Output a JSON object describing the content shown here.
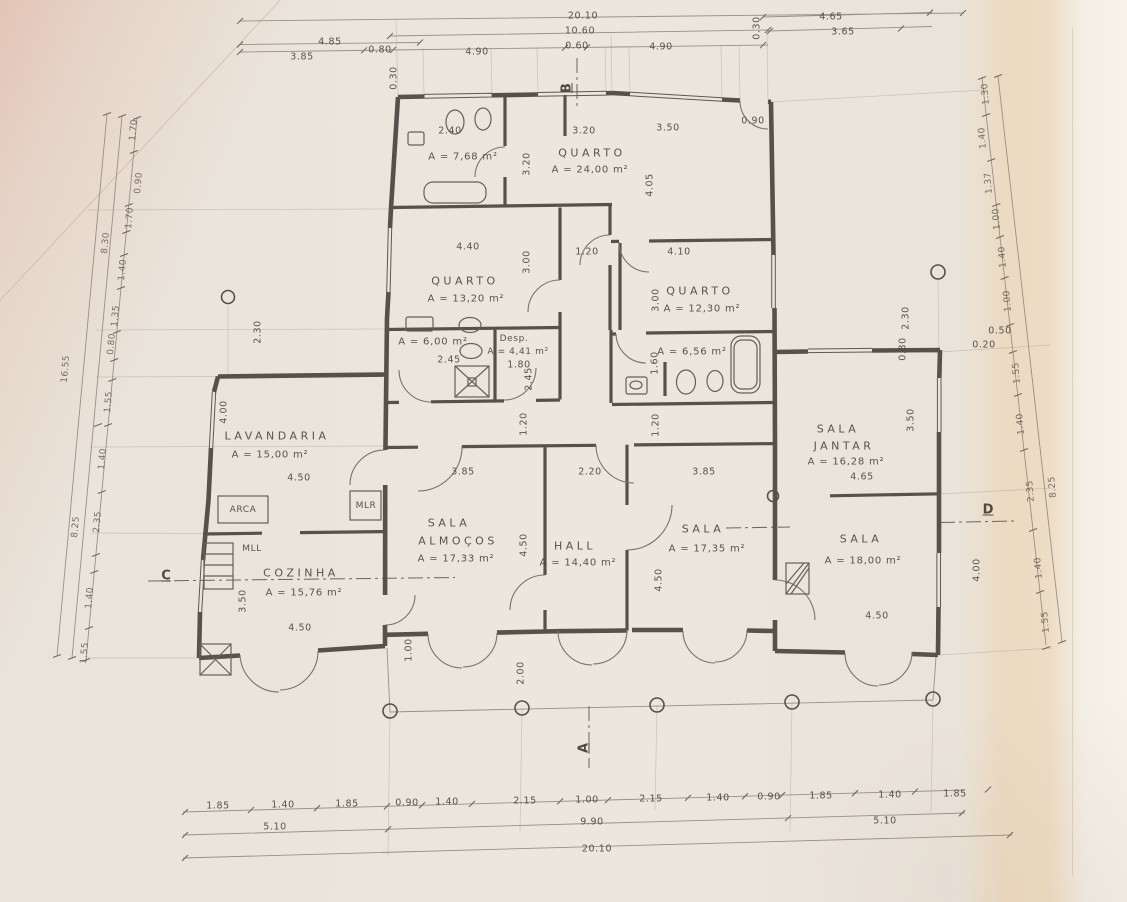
{
  "palette": {
    "paper": "#ebe5dc",
    "ink": "#56514b",
    "dim_line": "#9a9187",
    "text": "#49423a",
    "pink_fold": "#ddA694",
    "orange_band": "#e7b26e"
  },
  "drawing": {
    "type": "scanned architectural floor plan",
    "section_markers": [
      "A",
      "B",
      "C",
      "D"
    ]
  },
  "rooms": [
    {
      "name": "QUARTO",
      "area": "A = 24,00 m²"
    },
    {
      "name": "QUARTO",
      "area": "A = 13,20 m²"
    },
    {
      "name": "QUARTO",
      "area": "A = 12,30 m²"
    },
    {
      "name": "",
      "area": "A = 7,68 m²"
    },
    {
      "name": "",
      "area": "A = 6,00 m²"
    },
    {
      "name": "Desp.",
      "area": "A = 4,41 m²"
    },
    {
      "name": "",
      "area": "A = 6,56 m²"
    },
    {
      "name": "LAVANDARIA",
      "area": "A = 15,00 m²"
    },
    {
      "name": "COZINHA",
      "area": "A = 15,76 m²"
    },
    {
      "name": "SALA ALMOÇOS",
      "area": "A = 17,33 m²"
    },
    {
      "name": "HALL",
      "area": "A = 14,40 m²"
    },
    {
      "name": "SALA",
      "area": "A = 17,35 m²"
    },
    {
      "name": "SALA JANTAR",
      "area": "A = 16,28 m²"
    },
    {
      "name": "SALA",
      "area": "A = 18,00 m²"
    }
  ],
  "labels": [
    {
      "t": "QUARTO",
      "x": 592,
      "y": 153,
      "c": "room",
      "n": "room-label-quarto-24"
    },
    {
      "t": "A = 24,00 m²",
      "x": 590,
      "y": 170,
      "c": "area"
    },
    {
      "t": "A = 7,68 m²",
      "x": 463,
      "y": 157,
      "c": "area"
    },
    {
      "t": "QUARTO",
      "x": 465,
      "y": 281,
      "c": "room",
      "n": "room-label-quarto-13"
    },
    {
      "t": "A = 13,20 m²",
      "x": 466,
      "y": 299,
      "c": "area"
    },
    {
      "t": "QUARTO",
      "x": 700,
      "y": 291,
      "c": "room",
      "n": "room-label-quarto-12"
    },
    {
      "t": "A = 12,30 m²",
      "x": 702,
      "y": 309,
      "c": "area"
    },
    {
      "t": "A = 6,00 m²",
      "x": 433,
      "y": 342,
      "c": "area"
    },
    {
      "t": "Desp.",
      "x": 514,
      "y": 339,
      "c": "sm",
      "n": "room-label-despensa"
    },
    {
      "t": "A = 4,41 m²",
      "x": 518,
      "y": 352,
      "c": "sm"
    },
    {
      "t": "1.80",
      "x": 519,
      "y": 365,
      "c": "dim"
    },
    {
      "t": "A = 6,56 m²",
      "x": 692,
      "y": 352,
      "c": "area"
    },
    {
      "t": "LAVANDARIA",
      "x": 277,
      "y": 436,
      "c": "room",
      "n": "room-label-lavandaria"
    },
    {
      "t": "A = 15,00 m²",
      "x": 270,
      "y": 455,
      "c": "area"
    },
    {
      "t": "ARCA",
      "x": 243,
      "y": 510,
      "c": "sm",
      "n": "fixture-label-arca"
    },
    {
      "t": "MLR",
      "x": 366,
      "y": 506,
      "c": "sm",
      "n": "fixture-label-mlr"
    },
    {
      "t": "MLL",
      "x": 252,
      "y": 549,
      "c": "sm",
      "n": "fixture-label-mll"
    },
    {
      "t": "COZINHA",
      "x": 301,
      "y": 573,
      "c": "room",
      "n": "room-label-cozinha"
    },
    {
      "t": "A = 15,76 m²",
      "x": 304,
      "y": 593,
      "c": "area"
    },
    {
      "t": "SALA",
      "x": 449,
      "y": 523,
      "c": "room",
      "n": "room-label-sala-almocos"
    },
    {
      "t": "ALMOÇOS",
      "x": 458,
      "y": 541,
      "c": "room"
    },
    {
      "t": "A = 17,33 m²",
      "x": 456,
      "y": 559,
      "c": "area"
    },
    {
      "t": "HALL",
      "x": 575,
      "y": 546,
      "c": "room",
      "n": "room-label-hall"
    },
    {
      "t": "A = 14,40 m²",
      "x": 578,
      "y": 563,
      "c": "area"
    },
    {
      "t": "SALA",
      "x": 703,
      "y": 529,
      "c": "room",
      "n": "room-label-sala-17"
    },
    {
      "t": "A = 17,35 m²",
      "x": 707,
      "y": 549,
      "c": "area"
    },
    {
      "t": "SALA",
      "x": 838,
      "y": 429,
      "c": "room",
      "n": "room-label-sala-jantar"
    },
    {
      "t": "JANTAR",
      "x": 844,
      "y": 446,
      "c": "room"
    },
    {
      "t": "A = 16,28 m²",
      "x": 846,
      "y": 462,
      "c": "area"
    },
    {
      "t": "4.65",
      "x": 862,
      "y": 477,
      "c": "dim"
    },
    {
      "t": "SALA",
      "x": 861,
      "y": 539,
      "c": "room",
      "n": "room-label-sala-18"
    },
    {
      "t": "A = 18,00 m²",
      "x": 863,
      "y": 561,
      "c": "area"
    },
    {
      "t": "2.40",
      "x": 450,
      "y": 131,
      "c": "dim"
    },
    {
      "t": "3.20",
      "x": 584,
      "y": 131,
      "c": "dim"
    },
    {
      "t": "3.50",
      "x": 668,
      "y": 128,
      "c": "dim"
    },
    {
      "t": "0.90",
      "x": 753,
      "y": 121,
      "c": "dim"
    },
    {
      "t": "4.40",
      "x": 468,
      "y": 247,
      "c": "dim"
    },
    {
      "t": "1.20",
      "x": 587,
      "y": 252,
      "c": "dim"
    },
    {
      "t": "4.10",
      "x": 679,
      "y": 252,
      "c": "dim"
    },
    {
      "t": "2.45",
      "x": 449,
      "y": 360,
      "c": "dim"
    },
    {
      "t": "3.85",
      "x": 463,
      "y": 472,
      "c": "dim"
    },
    {
      "t": "2.20",
      "x": 590,
      "y": 472,
      "c": "dim"
    },
    {
      "t": "3.85",
      "x": 704,
      "y": 472,
      "c": "dim"
    },
    {
      "t": "4.50",
      "x": 299,
      "y": 478,
      "c": "dim"
    },
    {
      "t": "4.50",
      "x": 300,
      "y": 628,
      "c": "dim"
    },
    {
      "t": "4.50",
      "x": 877,
      "y": 616,
      "c": "dim"
    },
    {
      "t": "0.50",
      "x": 1000,
      "y": 331,
      "c": "dim"
    },
    {
      "t": "0.20",
      "x": 984,
      "y": 345,
      "c": "dim"
    },
    {
      "t": "3.20",
      "x": 527,
      "y": 164,
      "r": -90,
      "c": "dim"
    },
    {
      "t": "4.05",
      "x": 650,
      "y": 185,
      "r": -90,
      "c": "dim"
    },
    {
      "t": "3.00",
      "x": 527,
      "y": 262,
      "r": -90,
      "c": "dim"
    },
    {
      "t": "3.00",
      "x": 656,
      "y": 300,
      "r": -90,
      "c": "dim"
    },
    {
      "t": "2.45",
      "x": 529,
      "y": 379,
      "r": -90,
      "c": "dim"
    },
    {
      "t": "1.60",
      "x": 655,
      "y": 363,
      "r": -90,
      "c": "dim"
    },
    {
      "t": "1.20",
      "x": 524,
      "y": 424,
      "r": -90,
      "c": "dim"
    },
    {
      "t": "1.20",
      "x": 656,
      "y": 425,
      "r": -90,
      "c": "dim"
    },
    {
      "t": "4.50",
      "x": 524,
      "y": 545,
      "r": -90,
      "c": "dim"
    },
    {
      "t": "4.50",
      "x": 659,
      "y": 580,
      "r": -90,
      "c": "dim"
    },
    {
      "t": "4.00",
      "x": 224,
      "y": 412,
      "r": -90,
      "c": "dim"
    },
    {
      "t": "2.30",
      "x": 258,
      "y": 332,
      "r": -90,
      "c": "dim"
    },
    {
      "t": "3.50",
      "x": 243,
      "y": 601,
      "r": -90,
      "c": "dim"
    },
    {
      "t": "1.00",
      "x": 409,
      "y": 650,
      "r": -90,
      "c": "dim"
    },
    {
      "t": "2.00",
      "x": 521,
      "y": 673,
      "r": -90,
      "c": "dim"
    },
    {
      "t": "3.50",
      "x": 911,
      "y": 420,
      "r": -90,
      "c": "dim"
    },
    {
      "t": "4.00",
      "x": 977,
      "y": 570,
      "r": -90,
      "c": "dim"
    },
    {
      "t": "2.30",
      "x": 906,
      "y": 318,
      "r": -90,
      "c": "dim"
    },
    {
      "t": "0.30",
      "x": 903,
      "y": 349,
      "r": -90,
      "c": "dim"
    },
    {
      "t": "0.30",
      "x": 394,
      "y": 78,
      "r": -90,
      "c": "dim"
    },
    {
      "t": "0.30",
      "x": 757,
      "y": 28,
      "r": -90,
      "c": "dim"
    },
    {
      "t": "20.10",
      "x": 583,
      "y": 16,
      "c": "dim"
    },
    {
      "t": "10.60",
      "x": 580,
      "y": 31,
      "c": "dim"
    },
    {
      "t": "0.60",
      "x": 577,
      "y": 46,
      "c": "dim"
    },
    {
      "t": "4.85",
      "x": 330,
      "y": 42,
      "c": "dim"
    },
    {
      "t": "3.85",
      "x": 302,
      "y": 57,
      "c": "dim"
    },
    {
      "t": "0.80",
      "x": 380,
      "y": 50,
      "c": "dim"
    },
    {
      "t": "4.90",
      "x": 477,
      "y": 52,
      "c": "dim"
    },
    {
      "t": "4.90",
      "x": 661,
      "y": 47,
      "c": "dim"
    },
    {
      "t": "4.65",
      "x": 831,
      "y": 17,
      "c": "dim"
    },
    {
      "t": "3.65",
      "x": 843,
      "y": 32,
      "c": "dim"
    },
    {
      "t": "1.85",
      "x": 218,
      "y": 806,
      "c": "dim"
    },
    {
      "t": "1.40",
      "x": 283,
      "y": 805,
      "c": "dim"
    },
    {
      "t": "1.85",
      "x": 347,
      "y": 804,
      "c": "dim"
    },
    {
      "t": "0.90",
      "x": 407,
      "y": 803,
      "c": "dim"
    },
    {
      "t": "1.40",
      "x": 447,
      "y": 802,
      "c": "dim"
    },
    {
      "t": "2.15",
      "x": 525,
      "y": 801,
      "c": "dim"
    },
    {
      "t": "1.00",
      "x": 587,
      "y": 800,
      "c": "dim"
    },
    {
      "t": "2.15",
      "x": 651,
      "y": 799,
      "c": "dim"
    },
    {
      "t": "1.40",
      "x": 718,
      "y": 798,
      "c": "dim"
    },
    {
      "t": "0.90",
      "x": 769,
      "y": 797,
      "c": "dim"
    },
    {
      "t": "1.85",
      "x": 821,
      "y": 796,
      "c": "dim"
    },
    {
      "t": "1.40",
      "x": 890,
      "y": 795,
      "c": "dim"
    },
    {
      "t": "1.85",
      "x": 955,
      "y": 794,
      "c": "dim"
    },
    {
      "t": "5.10",
      "x": 275,
      "y": 827,
      "c": "dim"
    },
    {
      "t": "9.90",
      "x": 592,
      "y": 822,
      "c": "dim"
    },
    {
      "t": "5.10",
      "x": 885,
      "y": 821,
      "c": "dim"
    },
    {
      "t": "20.10",
      "x": 597,
      "y": 849,
      "c": "dim"
    },
    {
      "t": "1.70",
      "x": 134,
      "y": 130,
      "r": -85,
      "c": "chain"
    },
    {
      "t": "0.90",
      "x": 139,
      "y": 183,
      "r": -85,
      "c": "chain"
    },
    {
      "t": "1.70",
      "x": 130,
      "y": 218,
      "r": -85,
      "c": "chain"
    },
    {
      "t": "8.30",
      "x": 106,
      "y": 243,
      "r": -85,
      "c": "chain"
    },
    {
      "t": "1.40",
      "x": 123,
      "y": 270,
      "r": -85,
      "c": "chain"
    },
    {
      "t": "1.35",
      "x": 116,
      "y": 316,
      "r": -85,
      "c": "chain"
    },
    {
      "t": "0.80",
      "x": 112,
      "y": 344,
      "r": -85,
      "c": "chain"
    },
    {
      "t": "16.55",
      "x": 66,
      "y": 369,
      "r": -85,
      "c": "chain"
    },
    {
      "t": "1.55",
      "x": 109,
      "y": 402,
      "r": -85,
      "c": "chain"
    },
    {
      "t": "1.40",
      "x": 103,
      "y": 459,
      "r": -85,
      "c": "chain"
    },
    {
      "t": "2.35",
      "x": 98,
      "y": 522,
      "r": -85,
      "c": "chain"
    },
    {
      "t": "8.25",
      "x": 76,
      "y": 527,
      "r": -85,
      "c": "chain"
    },
    {
      "t": "1.40",
      "x": 90,
      "y": 598,
      "r": -85,
      "c": "chain"
    },
    {
      "t": "1.55",
      "x": 85,
      "y": 653,
      "r": -85,
      "c": "chain"
    },
    {
      "t": "1.30",
      "x": 986,
      "y": 94,
      "r": -95,
      "c": "chain"
    },
    {
      "t": "1.40",
      "x": 983,
      "y": 138,
      "r": -95,
      "c": "chain"
    },
    {
      "t": "1.37",
      "x": 989,
      "y": 183,
      "r": -95,
      "c": "chain"
    },
    {
      "t": "1.00",
      "x": 997,
      "y": 219,
      "r": -95,
      "c": "chain"
    },
    {
      "t": "1.40",
      "x": 1003,
      "y": 257,
      "r": -95,
      "c": "chain"
    },
    {
      "t": "1.00",
      "x": 1008,
      "y": 301,
      "r": -95,
      "c": "chain"
    },
    {
      "t": "1.55",
      "x": 1017,
      "y": 373,
      "r": -95,
      "c": "chain"
    },
    {
      "t": "1.40",
      "x": 1021,
      "y": 424,
      "r": -95,
      "c": "chain"
    },
    {
      "t": "2.35",
      "x": 1031,
      "y": 491,
      "r": -95,
      "c": "chain"
    },
    {
      "t": "8.25",
      "x": 1053,
      "y": 487,
      "r": -95,
      "c": "chain"
    },
    {
      "t": "1.40",
      "x": 1039,
      "y": 568,
      "r": -95,
      "c": "chain"
    },
    {
      "t": "1.55",
      "x": 1046,
      "y": 622,
      "r": -95,
      "c": "chain"
    },
    {
      "t": "B",
      "x": 567,
      "y": 88,
      "r": -90,
      "c": "mark",
      "n": "section-marker-b"
    },
    {
      "t": "A",
      "x": 584,
      "y": 748,
      "r": -90,
      "c": "mark",
      "n": "section-marker-a"
    },
    {
      "t": "C",
      "x": 166,
      "y": 576,
      "c": "mark",
      "n": "section-marker-c"
    },
    {
      "t": "D",
      "x": 988,
      "y": 510,
      "c": "mark",
      "n": "section-marker-d"
    }
  ]
}
